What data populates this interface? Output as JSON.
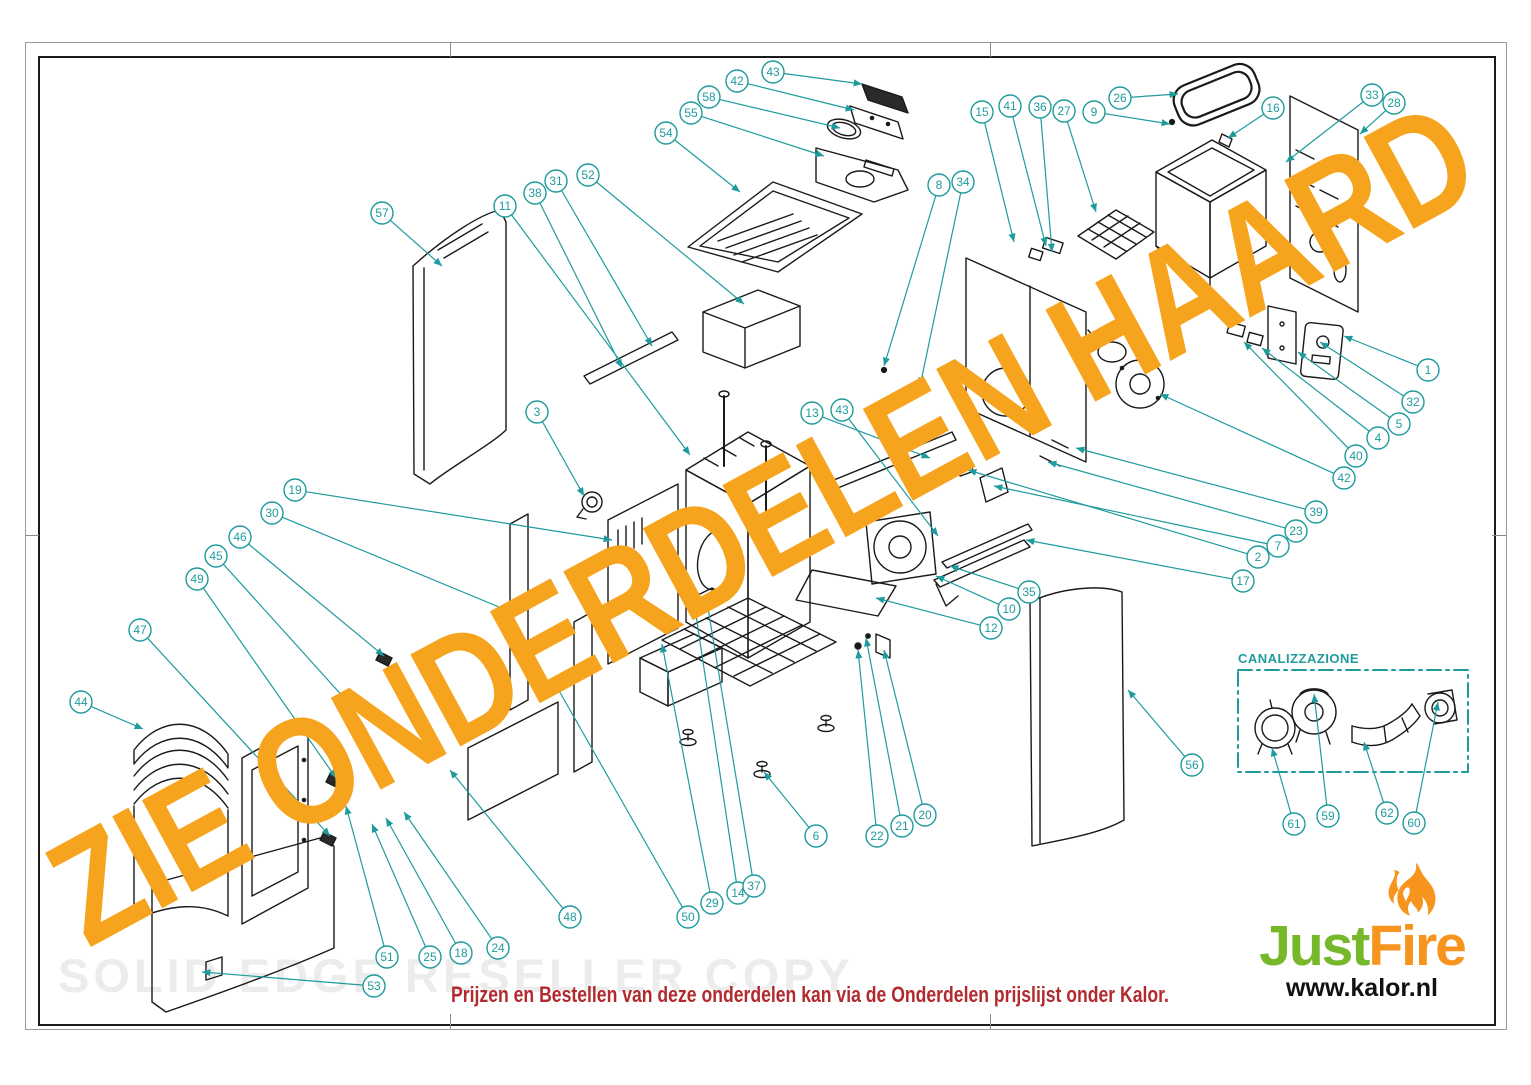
{
  "theme": {
    "callout_color": "#1F9B9D",
    "line_color": "#1A1A1A",
    "watermark_orange": "#F6A41D",
    "reseller_gray": "#ECECEC",
    "note_red": "#B22A2E",
    "logo_green": "#76B82A",
    "logo_orange": "#F7941E"
  },
  "watermark": {
    "text": "ZIE ONDERDELEN HAARD"
  },
  "reseller_watermark": {
    "text": "SOLID EDGE RESELLER COPY"
  },
  "footer": {
    "note": "Prijzen en Bestellen van deze onderdelen kan via de Onderdelen prijslijst onder Kalor."
  },
  "inset": {
    "label": "CANALIZZAZIONE"
  },
  "logo": {
    "name_green": "Just",
    "name_orange": "Fire",
    "url": "www.kalor.nl"
  },
  "callouts": [
    {
      "n": "43",
      "x": 773,
      "y": 72,
      "tx": 862,
      "ty": 84
    },
    {
      "n": "42",
      "x": 737,
      "y": 81,
      "tx": 854,
      "ty": 110
    },
    {
      "n": "58",
      "x": 709,
      "y": 97,
      "tx": 840,
      "ty": 128
    },
    {
      "n": "55",
      "x": 691,
      "y": 113,
      "tx": 824,
      "ty": 156
    },
    {
      "n": "54",
      "x": 666,
      "y": 133,
      "tx": 740,
      "ty": 192
    },
    {
      "n": "15",
      "x": 982,
      "y": 112,
      "tx": 1014,
      "ty": 242
    },
    {
      "n": "41",
      "x": 1010,
      "y": 106,
      "tx": 1046,
      "ty": 246
    },
    {
      "n": "36",
      "x": 1040,
      "y": 107,
      "tx": 1052,
      "ty": 252
    },
    {
      "n": "27",
      "x": 1064,
      "y": 111,
      "tx": 1096,
      "ty": 212
    },
    {
      "n": "9",
      "x": 1094,
      "y": 112,
      "tx": 1170,
      "ty": 124
    },
    {
      "n": "26",
      "x": 1120,
      "y": 98,
      "tx": 1178,
      "ty": 94
    },
    {
      "n": "16",
      "x": 1273,
      "y": 108,
      "tx": 1228,
      "ty": 138
    },
    {
      "n": "33",
      "x": 1372,
      "y": 95,
      "tx": 1286,
      "ty": 162
    },
    {
      "n": "28",
      "x": 1394,
      "y": 103,
      "tx": 1360,
      "ty": 134
    },
    {
      "n": "8",
      "x": 939,
      "y": 185,
      "tx": 884,
      "ty": 366
    },
    {
      "n": "34",
      "x": 963,
      "y": 182,
      "tx": 920,
      "ty": 386
    },
    {
      "n": "57",
      "x": 382,
      "y": 213,
      "tx": 442,
      "ty": 266
    },
    {
      "n": "11",
      "x": 505,
      "y": 206,
      "tx": 690,
      "ty": 455
    },
    {
      "n": "38",
      "x": 535,
      "y": 193,
      "tx": 622,
      "ty": 368
    },
    {
      "n": "31",
      "x": 556,
      "y": 181,
      "tx": 652,
      "ty": 346
    },
    {
      "n": "52",
      "x": 588,
      "y": 175,
      "tx": 744,
      "ty": 304
    },
    {
      "n": "3",
      "x": 537,
      "y": 412,
      "tx": 584,
      "ty": 496
    },
    {
      "n": "13",
      "x": 812,
      "y": 413,
      "tx": 930,
      "ty": 458
    },
    {
      "n": "43",
      "x": 842,
      "y": 410,
      "tx": 938,
      "ty": 536
    },
    {
      "n": "1",
      "x": 1428,
      "y": 370,
      "tx": 1344,
      "ty": 336
    },
    {
      "n": "32",
      "x": 1413,
      "y": 402,
      "tx": 1320,
      "ty": 342
    },
    {
      "n": "5",
      "x": 1399,
      "y": 424,
      "tx": 1298,
      "ty": 352
    },
    {
      "n": "4",
      "x": 1378,
      "y": 438,
      "tx": 1262,
      "ty": 348
    },
    {
      "n": "40",
      "x": 1356,
      "y": 456,
      "tx": 1244,
      "ty": 342
    },
    {
      "n": "42",
      "x": 1344,
      "y": 478,
      "tx": 1160,
      "ty": 394
    },
    {
      "n": "39",
      "x": 1316,
      "y": 512,
      "tx": 1076,
      "ty": 448
    },
    {
      "n": "23",
      "x": 1296,
      "y": 531,
      "tx": 1048,
      "ty": 462
    },
    {
      "n": "7",
      "x": 1278,
      "y": 546,
      "tx": 994,
      "ty": 486
    },
    {
      "n": "2",
      "x": 1258,
      "y": 557,
      "tx": 968,
      "ty": 470
    },
    {
      "n": "17",
      "x": 1243,
      "y": 581,
      "tx": 1026,
      "ty": 540
    },
    {
      "n": "19",
      "x": 295,
      "y": 490,
      "tx": 612,
      "ty": 540
    },
    {
      "n": "30",
      "x": 272,
      "y": 513,
      "tx": 516,
      "ty": 614
    },
    {
      "n": "46",
      "x": 240,
      "y": 537,
      "tx": 384,
      "ty": 656
    },
    {
      "n": "45",
      "x": 216,
      "y": 556,
      "tx": 346,
      "ty": 700
    },
    {
      "n": "49",
      "x": 197,
      "y": 579,
      "tx": 336,
      "ty": 778
    },
    {
      "n": "47",
      "x": 140,
      "y": 630,
      "tx": 330,
      "ty": 836
    },
    {
      "n": "44",
      "x": 81,
      "y": 702,
      "tx": 143,
      "ty": 729
    },
    {
      "n": "35",
      "x": 1029,
      "y": 592,
      "tx": 950,
      "ty": 566
    },
    {
      "n": "10",
      "x": 1009,
      "y": 609,
      "tx": 936,
      "ty": 576
    },
    {
      "n": "12",
      "x": 991,
      "y": 628,
      "tx": 876,
      "ty": 598
    },
    {
      "n": "56",
      "x": 1192,
      "y": 765,
      "tx": 1128,
      "ty": 690
    },
    {
      "n": "61",
      "x": 1294,
      "y": 824,
      "tx": 1272,
      "ty": 748
    },
    {
      "n": "59",
      "x": 1328,
      "y": 816,
      "tx": 1314,
      "ty": 694
    },
    {
      "n": "62",
      "x": 1387,
      "y": 813,
      "tx": 1364,
      "ty": 742
    },
    {
      "n": "60",
      "x": 1414,
      "y": 823,
      "tx": 1438,
      "ty": 702
    },
    {
      "n": "6",
      "x": 816,
      "y": 836,
      "tx": 764,
      "ty": 772
    },
    {
      "n": "22",
      "x": 877,
      "y": 836,
      "tx": 858,
      "ty": 650
    },
    {
      "n": "21",
      "x": 902,
      "y": 826,
      "tx": 866,
      "ty": 638
    },
    {
      "n": "20",
      "x": 925,
      "y": 815,
      "tx": 884,
      "ty": 650
    },
    {
      "n": "51",
      "x": 387,
      "y": 957,
      "tx": 346,
      "ty": 806
    },
    {
      "n": "53",
      "x": 374,
      "y": 986,
      "tx": 202,
      "ty": 972
    },
    {
      "n": "25",
      "x": 430,
      "y": 957,
      "tx": 372,
      "ty": 824
    },
    {
      "n": "18",
      "x": 461,
      "y": 953,
      "tx": 386,
      "ty": 818
    },
    {
      "n": "24",
      "x": 498,
      "y": 948,
      "tx": 404,
      "ty": 812
    },
    {
      "n": "48",
      "x": 570,
      "y": 917,
      "tx": 450,
      "ty": 770
    },
    {
      "n": "50",
      "x": 688,
      "y": 917,
      "tx": 554,
      "ty": 682
    },
    {
      "n": "29",
      "x": 712,
      "y": 903,
      "tx": 662,
      "ty": 644
    },
    {
      "n": "14",
      "x": 738,
      "y": 893,
      "tx": 694,
      "ty": 602
    },
    {
      "n": "37",
      "x": 754,
      "y": 886,
      "tx": 706,
      "ty": 596
    }
  ]
}
